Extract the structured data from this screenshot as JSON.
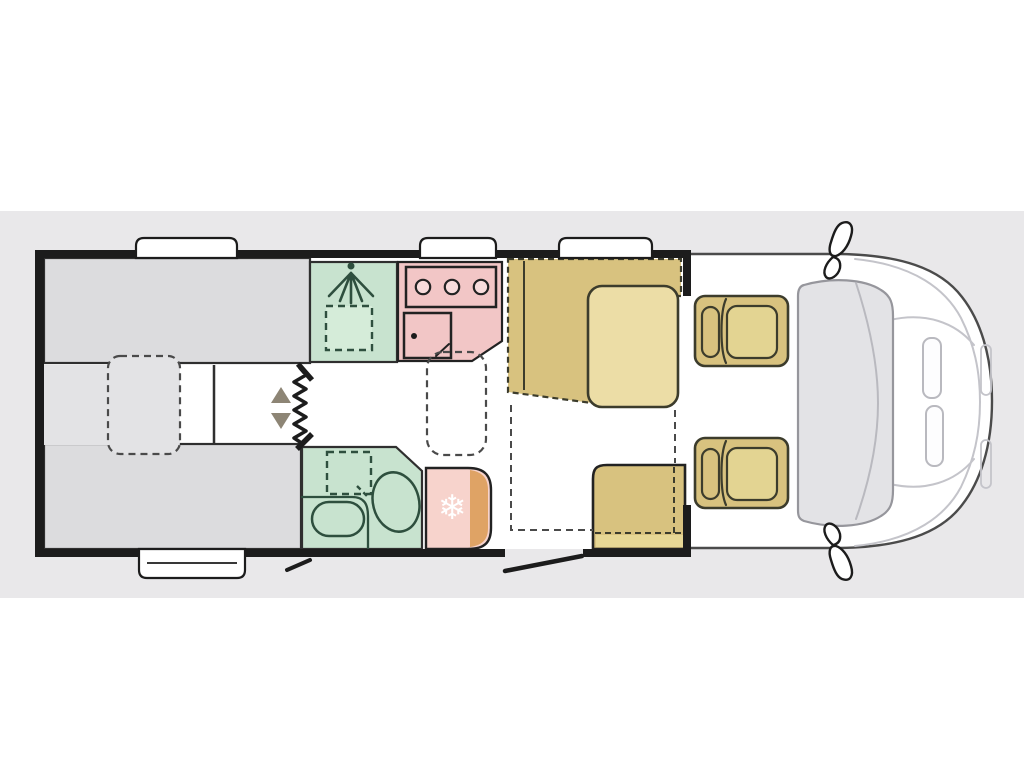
{
  "colors": {
    "page_bg": "#ffffff",
    "band_bg": "#e9e8ea",
    "wall": "#1c1c1c",
    "interior": "#ffffff",
    "bed_gray": "#dcdcde",
    "filler_gray": "#e3e3e5",
    "green_room": "#c8e3cf",
    "green_light": "#d5ecd9",
    "pink_kitchen": "#f2c6c6",
    "burner_fill": "#f8dcdc",
    "pink_fridge": "#f7d3cc",
    "orange_fridge_edge": "#dfa365",
    "tan_bench": "#d8c27f",
    "tan_table": "#ecdda6",
    "tan_bench_light": "#e7d795",
    "tan_seat_inner": "#e3d492",
    "arrow_brown": "#8d8575",
    "windshield_fill": "#e3e3e6",
    "white": "#ffffff"
  },
  "icons": {
    "shower_head": "shower-head-icon",
    "snowflake": "snowflake-icon",
    "snowflake_glyph": "❄",
    "arrow_up": "arrow-up-icon",
    "arrow_down": "arrow-down-icon",
    "zigzag_step": "zigzag-step-icon"
  }
}
